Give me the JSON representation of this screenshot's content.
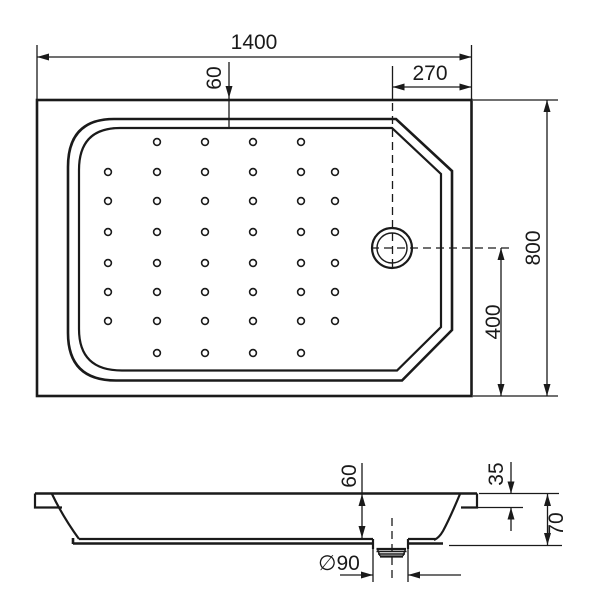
{
  "drawing": {
    "type": "shower-tray-technical-drawing",
    "background": "#ffffff",
    "line_color": "#1a1a1a",
    "top_view": {
      "overall_width": "1400",
      "rim_inset": "60",
      "drain_offset_right": "270",
      "overall_depth": "800",
      "drain_offset_bottom": "400"
    },
    "side_view": {
      "basin_depth": "60",
      "rim_step_height": "35",
      "overall_height": "70",
      "drain_diameter": "∅90"
    },
    "anti_slip_grid": {
      "row_ys": [
        142,
        172,
        201,
        232,
        263,
        292,
        321,
        353
      ],
      "col_xs": [
        108,
        157,
        205,
        253,
        301,
        335
      ],
      "short_row_indices": [
        0,
        7
      ],
      "short_row_col_indices": [
        1,
        2,
        3,
        4
      ],
      "dot_radius": 3.4
    }
  }
}
